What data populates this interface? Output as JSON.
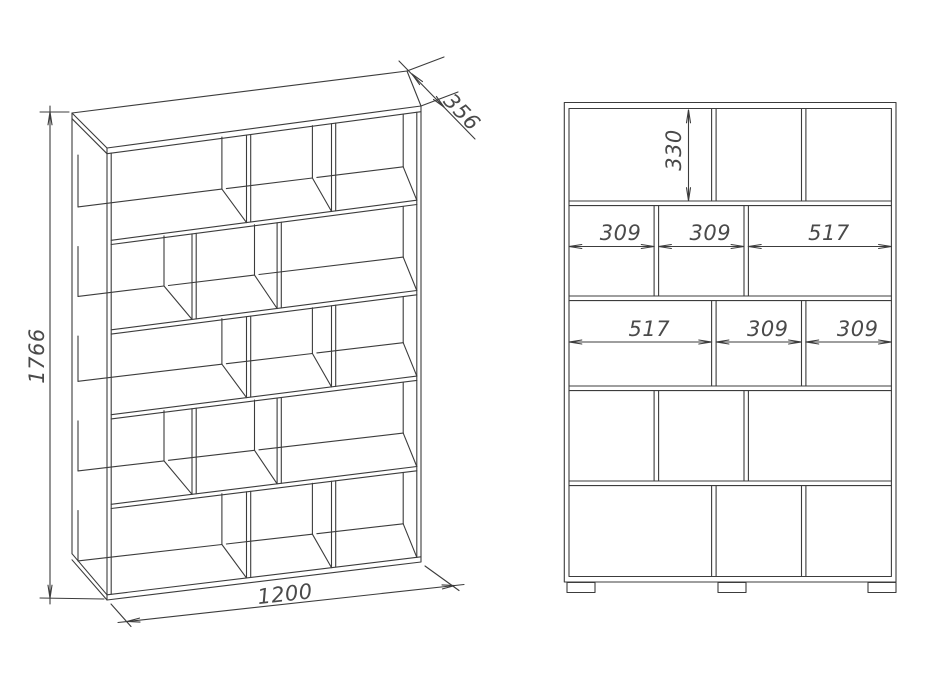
{
  "perspective_view": {
    "height_label": "1766",
    "width_label": "1200",
    "depth_label": "356"
  },
  "front_view": {
    "top_cell_height_label": "330",
    "row2_width_labels": [
      "309",
      "309",
      "517"
    ],
    "row3_width_labels": [
      "517",
      "309",
      "309"
    ]
  },
  "structure": {
    "type": "bookshelf-technical-drawing",
    "overall_mm": {
      "width": 1200,
      "height": 1766,
      "depth": 356
    },
    "rows_count": 5,
    "row_patterns_mm": [
      [
        517,
        309,
        309
      ],
      [
        309,
        309,
        517
      ],
      [
        517,
        309,
        309
      ],
      [
        309,
        309,
        517
      ],
      [
        517,
        309,
        309
      ]
    ],
    "top_cell_height_mm": 330,
    "legs_count": 3
  },
  "colors": {
    "line": "#3c3c3c",
    "text": "#4a4a4a",
    "background": "#ffffff"
  }
}
